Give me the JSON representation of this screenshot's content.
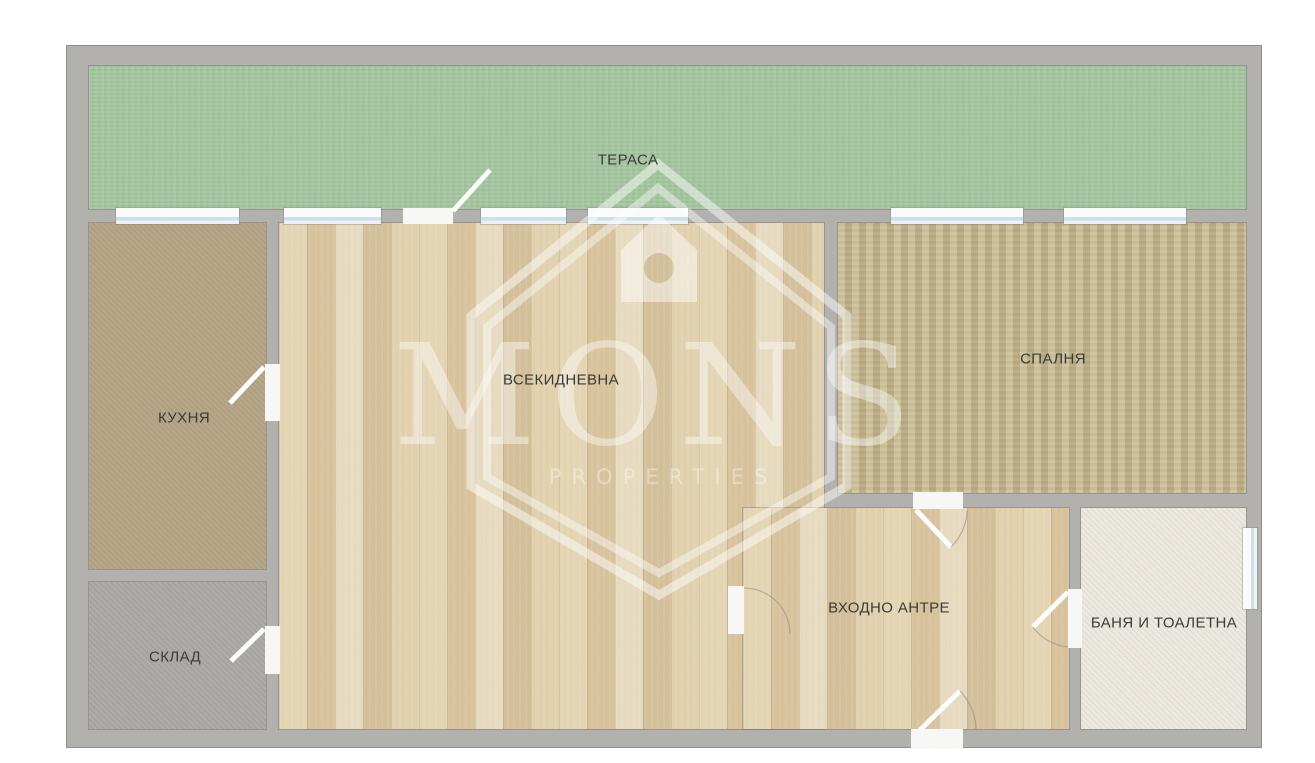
{
  "floor_plan": {
    "labels": {
      "terrace": "ТЕРАСА",
      "kitchen": "КУХНЯ",
      "storage": "СКЛАД",
      "living_room": "ВСЕКИДНЕВНА",
      "bedroom": "СПАЛНЯ",
      "entrance_hall": "ВХОДНО АНТРЕ",
      "bathroom": "БАНЯ И ТОАЛЕТНА"
    },
    "watermark": {
      "brand": "MONS",
      "tagline": "PROPERTIES"
    },
    "colors": {
      "wall": "#b3b1ae",
      "terrace_floor": "#a4c79f",
      "kitchen_floor": "#b4a282",
      "storage_floor": "#a9a8a6",
      "wood_floor": "#e1cfa9",
      "bedroom_carpet": "#cabc93",
      "bathroom_floor": "#ece8df",
      "window_glass": "#cfe3ed",
      "door_leaf": "#fbfbf9",
      "label_text": "#3c3a37",
      "watermark_white": "#ffffff"
    }
  }
}
